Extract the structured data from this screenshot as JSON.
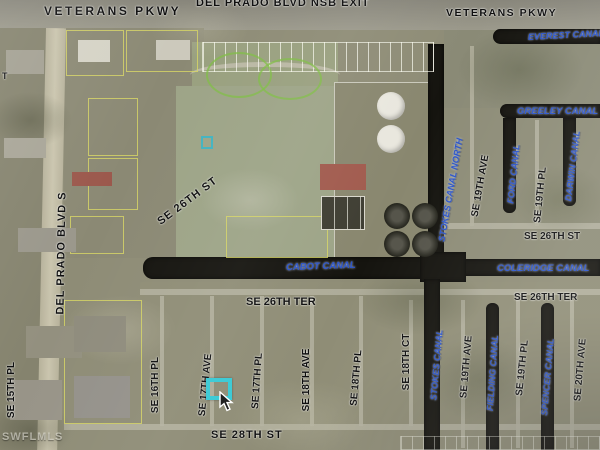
{
  "map": {
    "labels": {
      "veterans_pkwy_left": "VETERANS PKWY",
      "del_prado_nsb_exit": "DEL PRADO BLVD NSB EXIT",
      "veterans_pkwy_right": "VETERANS PKWY",
      "left_edge_partial": "T",
      "everest_canal": "EVEREST CANAL",
      "greeley_canal": "GREELEY CANAL",
      "stokes_canal_north": "STOKES CANAL NORTH",
      "se_19th_ave_north": "SE 19TH AVE",
      "ford_canal": "FORD CANAL",
      "se_19th_pl_north": "SE 19TH PL",
      "darwin_canal": "DARWIN CANAL",
      "se_26th_st_right": "SE 26TH ST",
      "coleridge_canal": "COLERIDGE CANAL",
      "se_26th_ter_right": "SE 26TH TER",
      "del_prado_blvd_s": "DEL PRADO BLVD S",
      "se_26th_st_diagonal": "SE 26TH ST",
      "cabot_canal": "CABOT CANAL",
      "se_26th_ter_mid": "SE 26TH TER",
      "se_15th_pl": "SE 15TH PL",
      "se_16th_pl": "SE 16TH PL",
      "se_17th_ave": "SE 17TH AVE",
      "se_17th_pl": "SE 17TH PL",
      "se_18th_ave": "SE 18TH AVE",
      "se_18th_pl": "SE 18TH PL",
      "se_18th_ct": "SE 18TH CT",
      "stokes_canal": "STOKES CANAL",
      "se_19th_ave_south": "SE 19TH AVE",
      "fielding_canal": "FIELDING CANAL",
      "se_19th_pl_south": "SE 19TH PL",
      "spencer_canal": "SPENCER CANAL",
      "se_20th_ave": "SE 20TH AVE",
      "se_28th_st": "SE 28TH ST",
      "watermark": "SWFLMLS"
    },
    "colors": {
      "canal_label": "#2B55CC",
      "street_label": "#0E0E0E",
      "parcel_highlight": "#38C9D4",
      "parcel_line": "#D8D765",
      "canal_water": "#15140F"
    }
  }
}
